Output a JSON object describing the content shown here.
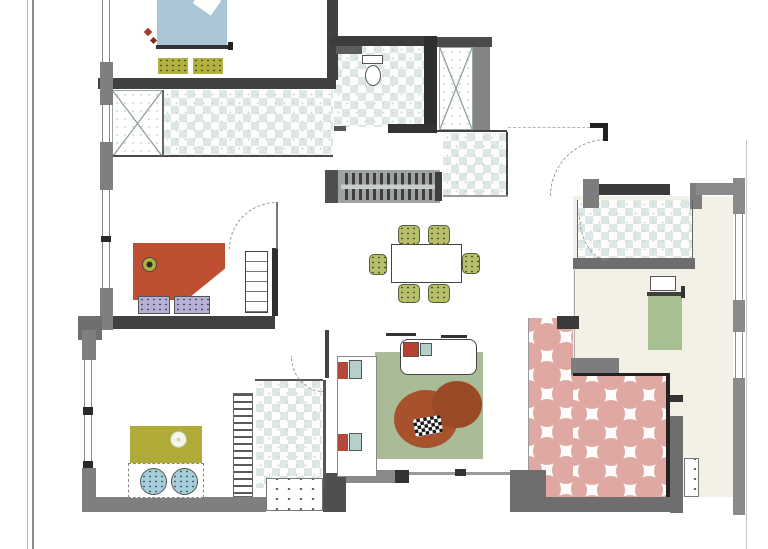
{
  "drawing": {
    "type": "apartment-floor-plan",
    "palette": {
      "wall_dark": "#3c3c3c",
      "wall_mid": "#6e6e6e",
      "wall_light": "#8a8a8a",
      "tile_blue": "#dde8e6",
      "tile_pink": "#dfa8a2",
      "floor_cream": "#f3f1e5",
      "bed_blue": "#a9c5d6",
      "olive": "#b1b13e",
      "chair_olive": "#b8bf6a",
      "bed_red": "#bf4f33",
      "pillow_lavender": "#b6b1d8",
      "bed_olive": "#b0ab36",
      "pillow_blue": "#a5cfdc",
      "rug_green": "#a9bb97",
      "rug_rust": "#a8512d",
      "bed_green": "#a8bf92",
      "accent_teal": "#b7cfcb",
      "accent_red": "#b0493a"
    }
  },
  "elements": [
    {
      "n": "sheet-border-outer-left",
      "x": 27,
      "y": 0,
      "w": 1,
      "h": 549,
      "b": "#b8b8b8"
    },
    {
      "n": "sheet-border-inner-left",
      "x": 32,
      "y": 0,
      "w": 2,
      "h": 549,
      "b": "#8d8d8d"
    },
    {
      "n": "sheet-border-right",
      "x": 746,
      "y": 140,
      "w": 1,
      "h": 409,
      "b": "#c6c6c6"
    },
    {
      "n": "floor-bedroom-right",
      "x": 573,
      "y": 196,
      "w": 160,
      "h": 301,
      "b": "#f3f1e5"
    },
    {
      "n": "shower-left",
      "c": "xroom",
      "x": 112,
      "y": 90,
      "w": 51,
      "h": 67
    },
    {
      "n": "bathroom-left-tiles",
      "c": "checker",
      "x": 163,
      "y": 90,
      "w": 170,
      "h": 67
    },
    {
      "n": "bathroom-top-tiles",
      "c": "checker",
      "x": 334,
      "y": 45,
      "w": 90,
      "h": 82
    },
    {
      "n": "closet-top",
      "c": "xroom",
      "x": 439,
      "y": 47,
      "w": 34,
      "h": 83
    },
    {
      "n": "bathroom-mid-tiles",
      "c": "checker",
      "x": 443,
      "y": 133,
      "w": 64,
      "h": 63
    },
    {
      "n": "bathroom-bottomleft-tiles",
      "c": "checker",
      "x": 256,
      "y": 380,
      "w": 66,
      "h": 108
    },
    {
      "n": "bathroom-right-tiles",
      "c": "checker",
      "x": 577,
      "y": 200,
      "w": 115,
      "h": 58
    },
    {
      "n": "terrace-tiles-strip",
      "c": "pink",
      "x": 528,
      "y": 318,
      "w": 45,
      "h": 180
    },
    {
      "n": "terrace-tiles-main",
      "c": "pink",
      "x": 573,
      "y": 376,
      "w": 95,
      "h": 121
    },
    {
      "n": "wall-bedroom1-bottom",
      "x": 98,
      "y": 78,
      "w": 238,
      "h": 11,
      "b": "#414141"
    },
    {
      "n": "wall-bedroom1-right",
      "x": 327,
      "y": 0,
      "w": 11,
      "h": 80,
      "b": "#414141"
    },
    {
      "n": "wall-bathroom-top",
      "x": 330,
      "y": 36,
      "w": 100,
      "h": 10,
      "b": "#3c3c3c"
    },
    {
      "n": "wall-closet-top",
      "x": 430,
      "y": 37,
      "w": 62,
      "h": 10,
      "b": "#4a4a4a"
    },
    {
      "n": "wall-bath-closet-divider",
      "x": 424,
      "y": 36,
      "w": 13,
      "h": 94,
      "b": "#2f2f2f"
    },
    {
      "n": "wall-closet-right",
      "x": 473,
      "y": 47,
      "w": 17,
      "h": 85,
      "b": "#848484"
    },
    {
      "n": "wall-bathroom-top-bottom",
      "x": 388,
      "y": 124,
      "w": 49,
      "h": 9,
      "b": "#333333"
    },
    {
      "n": "wall-bathroom-top-sill",
      "x": 334,
      "y": 126,
      "w": 12,
      "h": 5,
      "b": "#555555"
    },
    {
      "n": "line-bathroom-left-bottom",
      "x": 112,
      "y": 155,
      "w": 221,
      "h": 2,
      "b": "#4a4a4a"
    },
    {
      "n": "line-shower-divider",
      "x": 162,
      "y": 90,
      "w": 2,
      "h": 66,
      "b": "#666666"
    },
    {
      "n": "line-bath-mid-top",
      "x": 437,
      "y": 130,
      "w": 70,
      "h": 2,
      "b": "#444444"
    },
    {
      "n": "line-bath-mid-right",
      "x": 506,
      "y": 132,
      "w": 2,
      "h": 64,
      "b": "#444444"
    },
    {
      "n": "line-bath-mid-bottom",
      "x": 443,
      "y": 195,
      "w": 65,
      "h": 2,
      "b": "#999999"
    },
    {
      "n": "wall-left-seg1",
      "x": 100,
      "y": 62,
      "w": 13,
      "h": 43,
      "b": "#7f7f7f"
    },
    {
      "n": "wall-left-seg2",
      "x": 100,
      "y": 142,
      "w": 13,
      "h": 48,
      "b": "#7f7f7f"
    },
    {
      "n": "wall-left-seg3",
      "x": 100,
      "y": 288,
      "w": 13,
      "h": 42,
      "b": "#7f7f7f"
    },
    {
      "n": "window-left-1",
      "c": "winv",
      "x": 102,
      "y": 0,
      "w": 8,
      "h": 62
    },
    {
      "n": "window-left-2",
      "c": "winv",
      "x": 102,
      "y": 105,
      "w": 8,
      "h": 37
    },
    {
      "n": "window-left-3",
      "c": "winv",
      "x": 102,
      "y": 190,
      "w": 8,
      "h": 98
    },
    {
      "n": "window-tick-left",
      "x": 101,
      "y": 236,
      "w": 10,
      "h": 6,
      "b": "#2a2a2a"
    },
    {
      "n": "wall-bedroom2-bottom",
      "x": 113,
      "y": 316,
      "w": 162,
      "h": 13,
      "b": "#414141"
    },
    {
      "n": "wall-bedroom2-right",
      "x": 272,
      "y": 248,
      "w": 6,
      "h": 68,
      "b": "#2f2f2f"
    },
    {
      "n": "wall-corner-left",
      "x": 78,
      "y": 316,
      "w": 24,
      "h": 24,
      "b": "#6f6f6f"
    },
    {
      "n": "wall-left2-seg1",
      "x": 82,
      "y": 330,
      "w": 14,
      "h": 30,
      "b": "#7f7f7f"
    },
    {
      "n": "window-left2-1",
      "c": "winv",
      "x": 84,
      "y": 360,
      "w": 8,
      "h": 47
    },
    {
      "n": "window-tick-left2a",
      "x": 83,
      "y": 407,
      "w": 10,
      "h": 8,
      "b": "#2a2a2a"
    },
    {
      "n": "window-left2-2",
      "c": "winv",
      "x": 84,
      "y": 415,
      "w": 8,
      "h": 46
    },
    {
      "n": "window-tick-left2b",
      "x": 83,
      "y": 461,
      "w": 10,
      "h": 7,
      "b": "#2a2a2a"
    },
    {
      "n": "wall-left2-seg2",
      "x": 82,
      "y": 468,
      "w": 14,
      "h": 44,
      "b": "#7f7f7f"
    },
    {
      "n": "wall-bottom-left",
      "x": 88,
      "y": 497,
      "w": 178,
      "h": 15,
      "b": "#7f7f7f"
    },
    {
      "n": "entry-step",
      "c": "dots",
      "x": 266,
      "y": 478,
      "w": 57,
      "h": 33,
      "b": "#ffffff"
    },
    {
      "n": "wall-entry-block",
      "x": 323,
      "y": 473,
      "w": 23,
      "h": 39,
      "b": "#4f4f4f"
    },
    {
      "n": "wall-living-bottom",
      "x": 346,
      "y": 470,
      "w": 52,
      "h": 13,
      "b": "#8a8a8a"
    },
    {
      "n": "wall-living-bottom-tick",
      "x": 395,
      "y": 470,
      "w": 14,
      "h": 13,
      "b": "#333333"
    },
    {
      "n": "line-terrace-edge",
      "x": 409,
      "y": 472,
      "w": 120,
      "h": 3,
      "b": "#9a9a9a"
    },
    {
      "n": "tick-terrace-edge",
      "x": 455,
      "y": 469,
      "w": 11,
      "h": 7,
      "b": "#333333"
    },
    {
      "n": "line-living-left",
      "x": 325,
      "y": 330,
      "w": 4,
      "h": 48,
      "b": "#444444"
    },
    {
      "n": "line-bath4-top",
      "x": 255,
      "y": 379,
      "w": 68,
      "h": 2,
      "b": "#555555"
    },
    {
      "n": "line-bath4-right",
      "x": 323,
      "y": 380,
      "w": 3,
      "h": 110,
      "b": "#555555"
    },
    {
      "n": "ladder-shelf",
      "c": "hatchv",
      "x": 233,
      "y": 393,
      "w": 20,
      "h": 104
    },
    {
      "n": "wall-kitchen-block",
      "x": 325,
      "y": 170,
      "w": 20,
      "h": 33,
      "b": "#4f4f4f"
    },
    {
      "n": "kitchen-counter",
      "c": "counter",
      "x": 338,
      "y": 170,
      "w": 102,
      "h": 33
    },
    {
      "n": "kitchen-counter-end",
      "x": 435,
      "y": 172,
      "w": 7,
      "h": 29,
      "b": "#3f3f3f"
    },
    {
      "n": "wall-bath-right-top",
      "x": 595,
      "y": 184,
      "w": 75,
      "h": 11,
      "b": "#3a3a3a"
    },
    {
      "n": "wall-bath-right-left",
      "x": 583,
      "y": 179,
      "w": 16,
      "h": 29,
      "b": "#7d7d7d"
    },
    {
      "n": "wall-bath-right-right",
      "x": 690,
      "y": 183,
      "w": 12,
      "h": 26,
      "b": "#7d7d7d"
    },
    {
      "n": "wall-bedroom3-top",
      "x": 696,
      "y": 183,
      "w": 42,
      "h": 12,
      "b": "#8a8a8a"
    },
    {
      "n": "wall-bath-right-bottom",
      "x": 573,
      "y": 258,
      "w": 122,
      "h": 11,
      "b": "#6e6e6e"
    },
    {
      "n": "line-bath-right-left",
      "x": 577,
      "y": 200,
      "w": 1,
      "h": 58,
      "b": "#666666"
    },
    {
      "n": "line-bath-right-right",
      "x": 692,
      "y": 200,
      "w": 1,
      "h": 58,
      "b": "#666666"
    },
    {
      "n": "line-hall-bedroom",
      "x": 574,
      "y": 268,
      "w": 1,
      "h": 106,
      "b": "#aaaaaa"
    },
    {
      "n": "wall-right-seg1",
      "x": 733,
      "y": 178,
      "w": 12,
      "h": 36,
      "b": "#8a8a8a"
    },
    {
      "n": "window-right-1",
      "c": "winv",
      "x": 735,
      "y": 214,
      "w": 8,
      "h": 86
    },
    {
      "n": "wall-right-seg2",
      "x": 733,
      "y": 300,
      "w": 12,
      "h": 32,
      "b": "#8a8a8a"
    },
    {
      "n": "window-right-2",
      "c": "winv",
      "x": 735,
      "y": 332,
      "w": 8,
      "h": 46
    },
    {
      "n": "wall-right-seg3",
      "x": 733,
      "y": 378,
      "w": 12,
      "h": 137,
      "b": "#8a8a8a"
    },
    {
      "n": "wall-terrace-corner",
      "x": 557,
      "y": 316,
      "w": 22,
      "h": 13,
      "b": "#3a3a3a"
    },
    {
      "n": "line-terrace-strip-left",
      "x": 528,
      "y": 318,
      "w": 1,
      "h": 180,
      "b": "#999999"
    },
    {
      "n": "wall-terrace-gray-top",
      "x": 571,
      "y": 358,
      "w": 48,
      "h": 17,
      "b": "#7d7d7d"
    },
    {
      "n": "line-terrace-main-top",
      "x": 573,
      "y": 373,
      "w": 97,
      "h": 3,
      "b": "#222222"
    },
    {
      "n": "line-terrace-main-right",
      "x": 666,
      "y": 373,
      "w": 4,
      "h": 126,
      "b": "#222222"
    },
    {
      "n": "wall-terrace-right",
      "x": 670,
      "y": 416,
      "w": 13,
      "h": 97,
      "b": "#6e6e6e"
    },
    {
      "n": "wall-terrace-right-tick",
      "x": 670,
      "y": 395,
      "w": 13,
      "h": 7,
      "b": "#333333"
    },
    {
      "n": "wall-terrace-corner-bl",
      "x": 510,
      "y": 470,
      "w": 36,
      "h": 42,
      "b": "#6e6e6e"
    },
    {
      "n": "wall-terrace-bottom",
      "x": 528,
      "y": 497,
      "w": 150,
      "h": 15,
      "b": "#6e6e6e"
    },
    {
      "n": "terrace-step",
      "c": "dots",
      "x": 684,
      "y": 458,
      "w": 15,
      "h": 39,
      "b": "#ffffff"
    },
    {
      "n": "door-arc-entrance",
      "c": "arctl",
      "x": 550,
      "y": 139,
      "w": 57,
      "h": 57
    },
    {
      "n": "door-jamb-entrance-h",
      "x": 590,
      "y": 123,
      "w": 18,
      "h": 5,
      "b": "#222222"
    },
    {
      "n": "door-jamb-entrance-v",
      "x": 603,
      "y": 123,
      "w": 5,
      "h": 18,
      "b": "#222222"
    },
    {
      "n": "line-entry-dash",
      "c": "dash",
      "x": 508,
      "y": 127,
      "w": 82,
      "h": 1
    },
    {
      "n": "door-arc-bedroom2",
      "c": "arctl",
      "x": 229,
      "y": 202,
      "w": 48,
      "h": 47
    },
    {
      "n": "door-leaf-bedroom2",
      "x": 276,
      "y": 202,
      "w": 2,
      "h": 47,
      "b": "#777777"
    },
    {
      "n": "door-arc-bath4",
      "c": "arcbl",
      "x": 291,
      "y": 356,
      "w": 32,
      "h": 36
    },
    {
      "n": "door-arc-bath5",
      "c": "arcbl",
      "x": 579,
      "y": 214,
      "w": 28,
      "h": 46
    },
    {
      "n": "bed-double-blue",
      "x": 157,
      "y": 0,
      "w": 70,
      "h": 47,
      "b": "#a9c5d6"
    },
    {
      "n": "bed-blue-fold",
      "x": 196,
      "y": -7,
      "w": 22,
      "h": 18,
      "b": "#ffffff",
      "r": 35
    },
    {
      "n": "bed-blue-board",
      "x": 156,
      "y": 45,
      "w": 72,
      "h": 4,
      "b": "#333333"
    },
    {
      "n": "bed-blue-tick",
      "x": 228,
      "y": 42,
      "w": 5,
      "h": 8,
      "b": "#222222"
    },
    {
      "n": "nightstand-left",
      "c": "speck",
      "x": 158,
      "y": 58,
      "w": 30,
      "h": 16,
      "b": "#b1b13e"
    },
    {
      "n": "nightstand-right",
      "c": "speck",
      "x": 193,
      "y": 58,
      "w": 30,
      "h": 16,
      "b": "#b1b13e"
    },
    {
      "n": "decor-red-a",
      "x": 145,
      "y": 29,
      "w": 6,
      "h": 6,
      "b": "#a23b28",
      "r": 45
    },
    {
      "n": "decor-red-b",
      "x": 151,
      "y": 38,
      "w": 5,
      "h": 5,
      "b": "#7d2d1f",
      "r": 45
    },
    {
      "n": "bed-single-red",
      "c": "fold",
      "x": 133,
      "y": 243,
      "w": 92,
      "h": 57,
      "b": "#bf4f33"
    },
    {
      "n": "bed-red-flower",
      "c": "flower",
      "x": 142,
      "y": 257,
      "w": 15,
      "h": 15,
      "b": "#b1b13e"
    },
    {
      "n": "pillow-lavender-a",
      "c": "speck b3",
      "x": 138,
      "y": 296,
      "w": 32,
      "h": 18,
      "b": "#b6b1d8"
    },
    {
      "n": "pillow-lavender-b",
      "c": "speck b3",
      "x": 174,
      "y": 296,
      "w": 36,
      "h": 18,
      "b": "#b6b1d8"
    },
    {
      "n": "cabinet-shelves",
      "c": "shelf",
      "x": 245,
      "y": 251,
      "w": 23,
      "h": 62,
      "b": "#ffffff"
    },
    {
      "n": "bed-single-olive",
      "x": 130,
      "y": 426,
      "w": 72,
      "h": 37,
      "b": "#b0ab36"
    },
    {
      "n": "bed-olive-flower",
      "c": "flowerw",
      "x": 170,
      "y": 431,
      "w": 17,
      "h": 17,
      "b": "#f5f5ea"
    },
    {
      "n": "bed-olive-frame",
      "c": "dashb",
      "x": 128,
      "y": 463,
      "w": 76,
      "h": 35,
      "b": "#ffffff"
    },
    {
      "n": "pillow-round-a",
      "c": "round speck b3",
      "x": 140,
      "y": 468,
      "w": 27,
      "h": 27,
      "b": "#a5cfdc"
    },
    {
      "n": "pillow-round-b",
      "c": "round speck b3",
      "x": 171,
      "y": 468,
      "w": 27,
      "h": 27,
      "b": "#a5cfdc"
    },
    {
      "n": "dining-table",
      "c": "b1",
      "x": 391,
      "y": 244,
      "w": 71,
      "h": 39,
      "b": "#ffffff"
    },
    {
      "n": "chair-top-left",
      "c": "chair speck",
      "x": 398,
      "y": 225,
      "w": 22,
      "h": 20,
      "b": "#b8bf6a"
    },
    {
      "n": "chair-top-right",
      "c": "chair speck",
      "x": 428,
      "y": 225,
      "w": 22,
      "h": 20,
      "b": "#b8bf6a"
    },
    {
      "n": "chair-bottom-left",
      "c": "chair speck",
      "x": 398,
      "y": 284,
      "w": 22,
      "h": 19,
      "b": "#b8bf6a"
    },
    {
      "n": "chair-bottom-right",
      "c": "chair speck",
      "x": 428,
      "y": 284,
      "w": 22,
      "h": 19,
      "b": "#b8bf6a"
    },
    {
      "n": "chair-left",
      "c": "chair speck",
      "x": 369,
      "y": 254,
      "w": 18,
      "h": 21,
      "b": "#b8bf6a"
    },
    {
      "n": "chair-right",
      "c": "chair speck",
      "x": 462,
      "y": 253,
      "w": 18,
      "h": 21,
      "b": "#b8bf6a"
    },
    {
      "n": "rug-living",
      "x": 375,
      "y": 352,
      "w": 108,
      "h": 107,
      "b": "#a9bb97"
    },
    {
      "n": "tv-board",
      "c": "b2",
      "x": 337,
      "y": 356,
      "w": 40,
      "h": 121,
      "b": "#ffffff"
    },
    {
      "n": "speaker-top-red",
      "x": 338,
      "y": 362,
      "w": 10,
      "h": 17,
      "b": "#b0493a"
    },
    {
      "n": "speaker-top-teal",
      "c": "b3",
      "x": 349,
      "y": 360,
      "w": 13,
      "h": 19,
      "b": "#b7cfcb"
    },
    {
      "n": "speaker-bottom-red",
      "x": 338,
      "y": 434,
      "w": 10,
      "h": 17,
      "b": "#b0493a"
    },
    {
      "n": "speaker-bottom-teal",
      "c": "b3",
      "x": 349,
      "y": 433,
      "w": 13,
      "h": 18,
      "b": "#b7cfcb"
    },
    {
      "n": "sofa",
      "c": "b1 br8",
      "x": 400,
      "y": 339,
      "w": 77,
      "h": 36,
      "b": "#ffffff"
    },
    {
      "n": "sofa-pillow-red",
      "c": "b3",
      "x": 403,
      "y": 342,
      "w": 16,
      "h": 15,
      "b": "#b5412e"
    },
    {
      "n": "sofa-pillow-teal",
      "c": "b3",
      "x": 420,
      "y": 343,
      "w": 12,
      "h": 13,
      "b": "#b7cfcb"
    },
    {
      "n": "wall-dash-sofa-a",
      "x": 386,
      "y": 333,
      "w": 30,
      "h": 3,
      "b": "#333333"
    },
    {
      "n": "wall-dash-sofa-b",
      "x": 441,
      "y": 335,
      "w": 26,
      "h": 3,
      "b": "#333333"
    },
    {
      "n": "rug-beanbag-large",
      "c": "round",
      "x": 394,
      "y": 390,
      "w": 64,
      "h": 58,
      "b": "#a8512d"
    },
    {
      "n": "rug-beanbag-small",
      "c": "round",
      "x": 432,
      "y": 381,
      "w": 50,
      "h": 47,
      "b": "#9a4a26"
    },
    {
      "n": "beanbag-pillow",
      "c": "bw",
      "x": 414,
      "y": 417,
      "w": 28,
      "h": 18,
      "r": -10
    },
    {
      "n": "bed-green-pillow",
      "c": "b3",
      "x": 650,
      "y": 276,
      "w": 26,
      "h": 15,
      "b": "#ffffff"
    },
    {
      "n": "bed-green-board",
      "x": 647,
      "y": 292,
      "w": 38,
      "h": 4,
      "b": "#3f3f3f"
    },
    {
      "n": "bed-single-green",
      "x": 648,
      "y": 296,
      "w": 34,
      "h": 54,
      "b": "#a8bf92"
    },
    {
      "n": "bed-green-tick",
      "x": 681,
      "y": 286,
      "w": 4,
      "h": 12,
      "b": "#333333"
    },
    {
      "n": "toilet-tank",
      "c": "b3",
      "x": 362,
      "y": 55,
      "w": 21,
      "h": 9,
      "b": "#ffffff"
    },
    {
      "n": "toilet-bowl",
      "c": "b3 round",
      "x": 365,
      "y": 65,
      "w": 16,
      "h": 21,
      "b": "#ffffff"
    },
    {
      "n": "bath-top-fixture",
      "x": 336,
      "y": 46,
      "w": 26,
      "h": 8,
      "b": "#5d5d5d"
    }
  ]
}
